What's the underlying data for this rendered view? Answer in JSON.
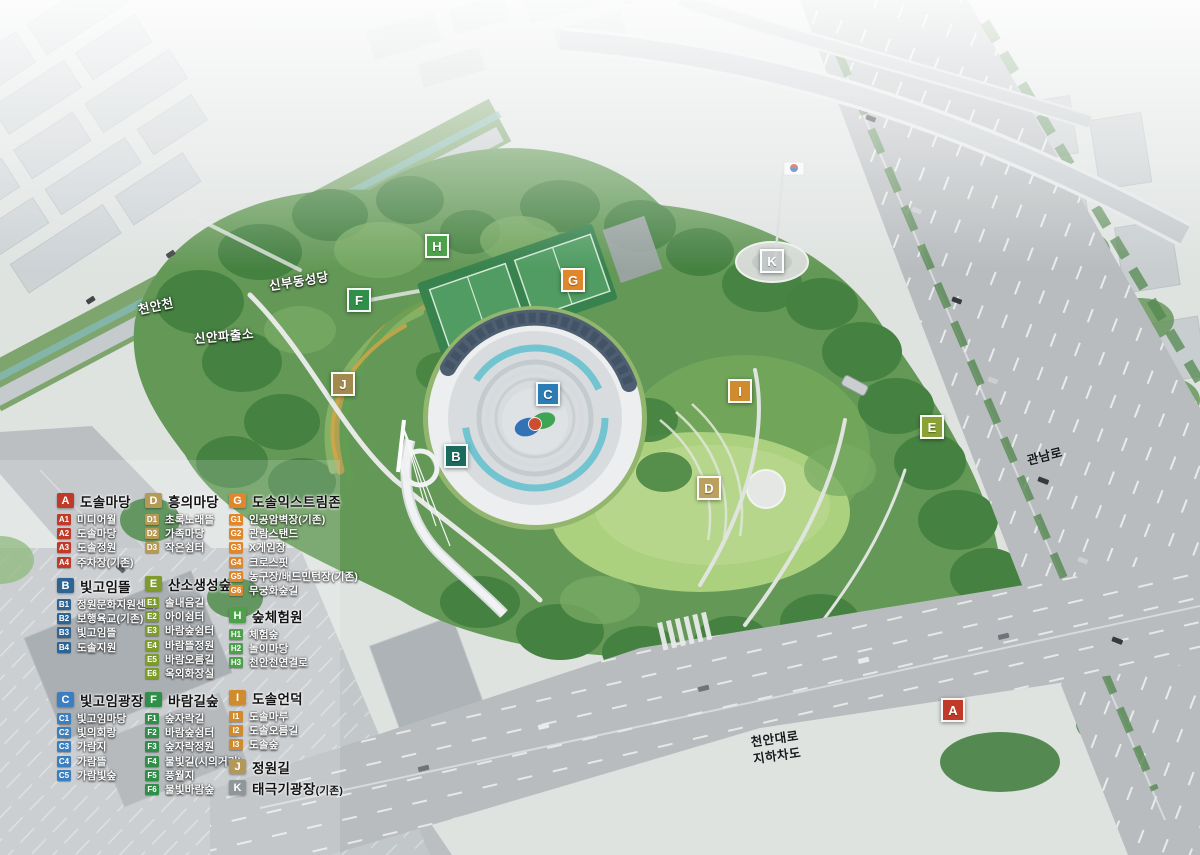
{
  "map_labels": [
    {
      "name": "label-cheonancheon",
      "text": "천안천",
      "x": 156,
      "y": 307,
      "rot": -12,
      "style": "light"
    },
    {
      "name": "label-sinbudong-cathedral",
      "text": "신부동성당",
      "x": 299,
      "y": 282,
      "rot": -9,
      "style": "light"
    },
    {
      "name": "label-sinan-police-station",
      "text": "신안파출소",
      "x": 224,
      "y": 337,
      "rot": -5,
      "style": "light"
    },
    {
      "name": "label-gwannam-ro",
      "text": "관남로",
      "x": 1045,
      "y": 457,
      "rot": -14,
      "style": "dark"
    },
    {
      "name": "label-cheonan-daero-underpass",
      "text": "천안대로\n지하차도",
      "x": 776,
      "y": 748,
      "rot": -8,
      "style": "dark"
    }
  ],
  "markers": [
    {
      "letter": "H",
      "x": 437,
      "y": 246,
      "color": "#4da14b"
    },
    {
      "letter": "F",
      "x": 359,
      "y": 300,
      "color": "#2f8f48"
    },
    {
      "letter": "G",
      "x": 573,
      "y": 280,
      "color": "#e0872b"
    },
    {
      "letter": "K",
      "x": 772,
      "y": 261,
      "color": "#b8bec1",
      "translucent": true
    },
    {
      "letter": "J",
      "x": 343,
      "y": 384,
      "color": "#a28a4e"
    },
    {
      "letter": "B",
      "x": 456,
      "y": 456,
      "color": "#1a6a5e"
    },
    {
      "letter": "C",
      "x": 548,
      "y": 394,
      "color": "#2b7cb5"
    },
    {
      "letter": "I",
      "x": 740,
      "y": 391,
      "color": "#cf8b2e"
    },
    {
      "letter": "E",
      "x": 932,
      "y": 427,
      "color": "#8aa136"
    },
    {
      "letter": "D",
      "x": 709,
      "y": 488,
      "color": "#bba05f"
    },
    {
      "letter": "A",
      "x": 953,
      "y": 710,
      "color": "#bf3a28"
    }
  ],
  "legend": {
    "sections": [
      {
        "id": "A",
        "title": "도솔마당",
        "color": "#bf3a28",
        "items": [
          [
            "A1",
            "미디어월"
          ],
          [
            "A2",
            "도솔마당"
          ],
          [
            "A3",
            "도솔정원"
          ],
          [
            "A4",
            "주차장(기존)"
          ]
        ]
      },
      {
        "id": "B",
        "title": "빛고임뜰",
        "color": "#2e6494",
        "items": [
          [
            "B1",
            "정원문화지원센터"
          ],
          [
            "B2",
            "보행육교(기존)"
          ],
          [
            "B3",
            "빛고임뜰"
          ],
          [
            "B4",
            "도솔지원"
          ]
        ]
      },
      {
        "id": "C",
        "title": "빛고임광장",
        "color": "#3b7fc0",
        "items": [
          [
            "C1",
            "빛고임마당"
          ],
          [
            "C2",
            "빛의회랑"
          ],
          [
            "C3",
            "가람지"
          ],
          [
            "C4",
            "가람뜰"
          ],
          [
            "C5",
            "가람빛숲"
          ]
        ]
      },
      {
        "id": "D",
        "title": "흥의마당",
        "color": "#b49a55",
        "items": [
          [
            "D1",
            "초록노래뜰"
          ],
          [
            "D2",
            "가족마당"
          ],
          [
            "D3",
            "작은쉼터"
          ]
        ]
      },
      {
        "id": "E",
        "title": "산소생성숲",
        "color": "#7e9c2c",
        "items": [
          [
            "E1",
            "솔내음길"
          ],
          [
            "E2",
            "아이쉼터"
          ],
          [
            "E3",
            "바람숲쉼터"
          ],
          [
            "E4",
            "바람뜰정원"
          ],
          [
            "E5",
            "바람오름길"
          ],
          [
            "E6",
            "옥외화장실"
          ]
        ]
      },
      {
        "id": "F",
        "title": "바람길숲",
        "color": "#2f8f48",
        "items": [
          [
            "F1",
            "숲자락길"
          ],
          [
            "F2",
            "바람숲쉼터"
          ],
          [
            "F3",
            "숲자락정원"
          ],
          [
            "F4",
            "물빛길(시의거리)"
          ],
          [
            "F5",
            "풍월지"
          ],
          [
            "F6",
            "물빛바람숲"
          ]
        ]
      },
      {
        "id": "G",
        "title": "도솔익스트림존",
        "color": "#e0872b",
        "items": [
          [
            "G1",
            "인공암벽장(기존)"
          ],
          [
            "G2",
            "관람스탠드"
          ],
          [
            "G3",
            "X게임장"
          ],
          [
            "G4",
            "크로스핏"
          ],
          [
            "G5",
            "농구장/배드민턴장(기존)"
          ],
          [
            "G6",
            "무궁화숲길"
          ]
        ]
      },
      {
        "id": "H",
        "title": "숲체험원",
        "color": "#4da14b",
        "items": [
          [
            "H1",
            "체험숲"
          ],
          [
            "H2",
            "놀이마당"
          ],
          [
            "H3",
            "천안천연결로"
          ]
        ]
      },
      {
        "id": "I",
        "title": "도솔언덕",
        "color": "#cf8b2e",
        "items": [
          [
            "I1",
            "도솔마루"
          ],
          [
            "I2",
            "도솔오름길"
          ],
          [
            "I3",
            "도솔숲"
          ]
        ]
      },
      {
        "id": "J",
        "title": "정원길",
        "color": "#b2995a",
        "items": []
      },
      {
        "id": "K",
        "title": "태극기광장",
        "suffix": "(기존)",
        "color": "#8f979b",
        "items": []
      }
    ]
  }
}
